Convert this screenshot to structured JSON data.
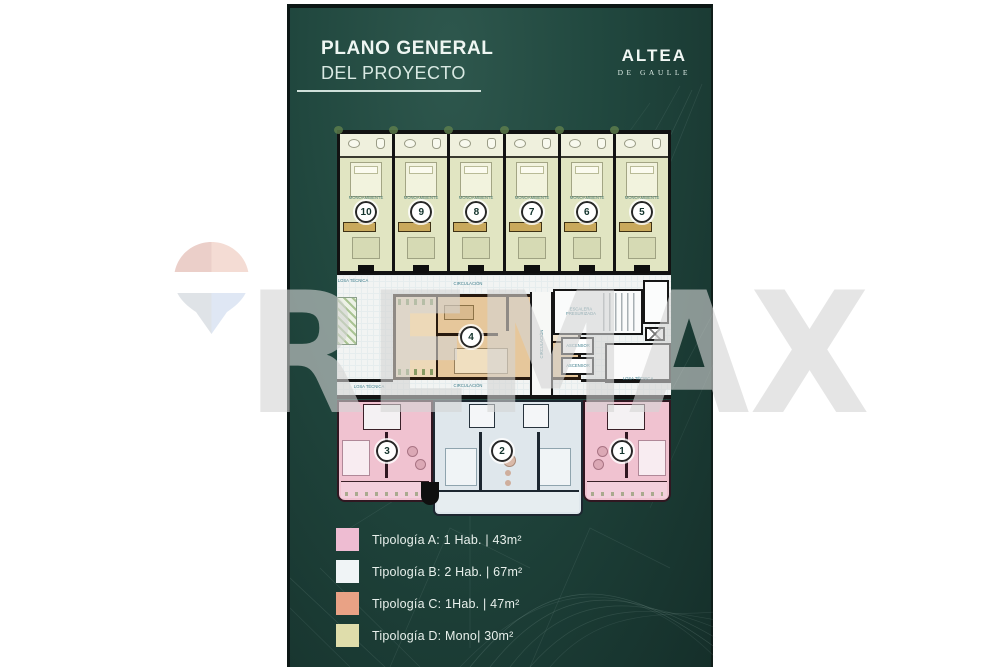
{
  "header": {
    "title_line1": "PLANO GENERAL",
    "title_line2": "DEL PROYECTO"
  },
  "brand": {
    "logo_text": "ALTEA",
    "logo_subtitle": "DE GAULLE"
  },
  "watermark": {
    "text": "REMAX",
    "balloon_icon": "remax-balloon"
  },
  "floorplan": {
    "unit_label_mono": "MONOAMBIENTE",
    "top_units": [
      {
        "number": "10"
      },
      {
        "number": "9"
      },
      {
        "number": "8"
      },
      {
        "number": "7"
      },
      {
        "number": "6"
      },
      {
        "number": "5"
      }
    ],
    "middle_unit": {
      "number": "4"
    },
    "bottom_units": [
      {
        "number": "3"
      },
      {
        "number": "2"
      },
      {
        "number": "1"
      }
    ],
    "labels": {
      "circulacion_top": "CIRCULACIÓN",
      "circulacion_bottom": "CIRCULACIÓN",
      "circulacion_vertical": "CIRCULACIÓN",
      "losa_tecnica_top_left": "LOSA TÉCNICA",
      "losa_tecnica_bottom_left": "LOSA TÉCNICA",
      "losa_tecnica_bottom_right": "LOSA TÉCNICA",
      "escalera_presurizada": "ESCALERA PRESURIZADA",
      "ascensor_1": "ASCENSOR",
      "ascensor_2": "ASCENSOR"
    }
  },
  "legend": {
    "items": [
      {
        "label": "Tipología A: 1 Hab. | 43m²",
        "color": "#eebcd2"
      },
      {
        "label": "Tipología B: 2 Hab. | 67m²",
        "color": "#f0f4f6"
      },
      {
        "label": "Tipología C: 1Hab. | 47m²",
        "color": "#e9a285"
      },
      {
        "label": "Tipología D: Mono| 30m²",
        "color": "#dfddab"
      }
    ]
  },
  "colors": {
    "panel_green": "#1e443c",
    "unit_type_a": "#f0c2d0",
    "unit_type_b": "#dfe7ec",
    "unit_type_c": "#e6c79b",
    "unit_type_d": "#e1e5c2",
    "walls": "#141414",
    "plan_label_teal": "#3e7e8c"
  }
}
